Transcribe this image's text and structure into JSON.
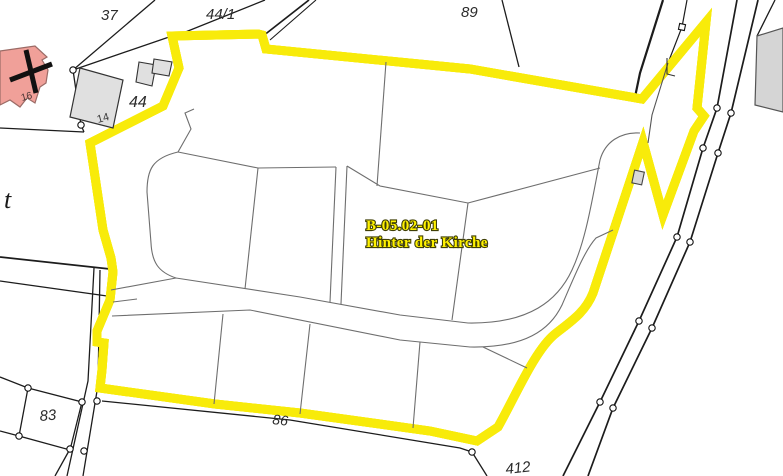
{
  "plan": {
    "code": "B-05.02-01",
    "name": "Hinter der Kirche"
  },
  "labels": {
    "parcel_37": "37",
    "parcel_44_1": "44/1",
    "parcel_89": "89",
    "parcel_44": "44",
    "parcel_83": "83",
    "parcel_86": "86",
    "parcel_412": "412",
    "house_14": "14",
    "house_16": "16",
    "street_t": "t"
  },
  "colors": {
    "background": "#ffffff",
    "plan_area_fill": "#adadad",
    "plan_boundary_yellow": "#f8eb0a",
    "plan_outline": "#6a6a6a",
    "internal_line": "#6e6e6e",
    "parcel_line": "#1c1c1c",
    "plan_label_fill": "#fff200",
    "church_fill": "#f0a099",
    "church_stroke": "#9b6b66",
    "building_fill": "#e0e0e0",
    "corner_parcel_fill": "#d5d5d5"
  }
}
